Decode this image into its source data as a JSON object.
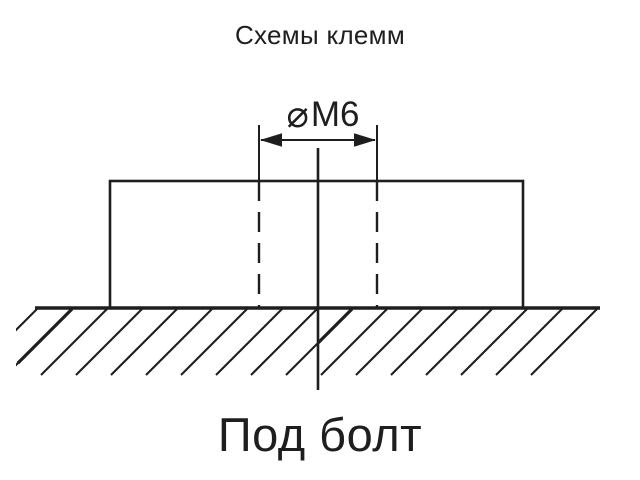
{
  "title": "Схемы клемм",
  "dimension": {
    "symbol": "⌀",
    "value": "M6"
  },
  "caption": "Под болт",
  "colors": {
    "ink": "#1e1e1e",
    "paper": "#ffffff"
  }
}
